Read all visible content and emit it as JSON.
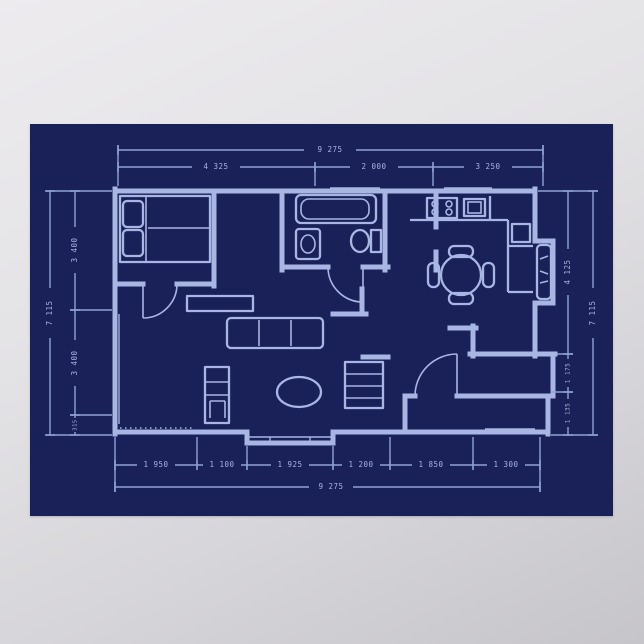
{
  "poster": {
    "kind": "blueprint-floor-plan-poster",
    "colors": {
      "poster_navy": "#1a2158",
      "blueprint_line": "#a9b5e2",
      "dimension_line": "#8fa3d8",
      "backdrop_gray": "#dcdadd"
    }
  },
  "dimensions": {
    "top": {
      "total": "9 275",
      "segments": [
        "4 325",
        "2 000",
        "3 250"
      ]
    },
    "bottom": {
      "total": "9 275",
      "segments": [
        "1 950",
        "1 100",
        "1 925",
        "1 200",
        "1 850",
        "1 300"
      ]
    },
    "left": {
      "total": "7 115",
      "segments": [
        "3 400",
        "3 400",
        "315"
      ]
    },
    "right": {
      "total": "7 115",
      "segments": [
        "4 125",
        "1 175",
        "1 135"
      ]
    }
  }
}
